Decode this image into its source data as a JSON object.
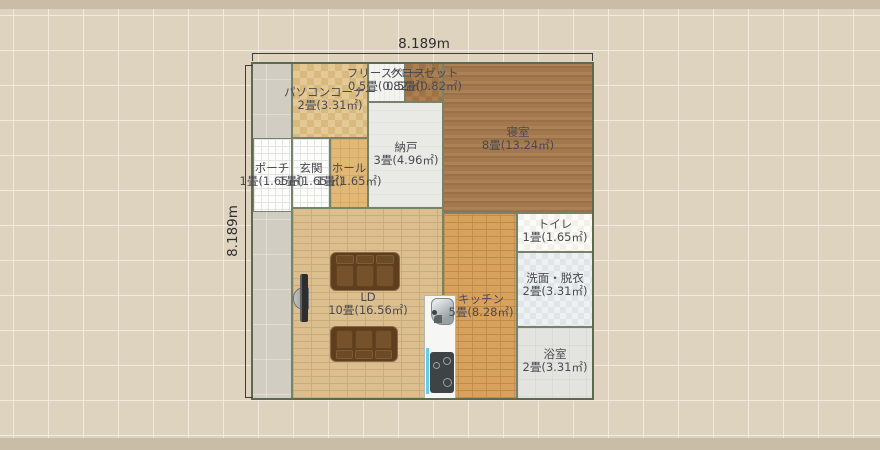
{
  "plan": {
    "dimensions": {
      "width_label": "8.189m",
      "height_label": "8.189m"
    },
    "rooms": {
      "pc_corner": {
        "name": "パソコンコーナー",
        "size": "2畳(3.31㎡)"
      },
      "free_space": {
        "name": "フリースペース",
        "size": "0.5畳(0.82㎡)"
      },
      "closet": {
        "name": "クローゼット",
        "size": "0.5畳(0.82㎡)"
      },
      "storage": {
        "name": "納戸",
        "size": "3畳(4.96㎡)"
      },
      "bedroom": {
        "name": "寝室",
        "size": "8畳(13.24㎡)"
      },
      "porch": {
        "name": "ポーチ",
        "size": "1畳(1.65㎡)"
      },
      "entrance": {
        "name": "玄関",
        "size": "1畳(1.65㎡)"
      },
      "hall": {
        "name": "ホール",
        "size": "1畳(1.65㎡)"
      },
      "living_dining": {
        "name": "LD",
        "size": "10畳(16.56㎡)"
      },
      "kitchen": {
        "name": "キッチン",
        "size": "5畳(8.28㎡)"
      },
      "toilet": {
        "name": "トイレ",
        "size": "1畳(1.65㎡)"
      },
      "washroom": {
        "name": "洗面・脱衣",
        "size": "2畳(3.31㎡)"
      },
      "bathroom": {
        "name": "浴室",
        "size": "2畳(3.31㎡)"
      }
    },
    "furniture": [
      "sofa",
      "sofa",
      "tv",
      "refrigerator",
      "stove",
      "sink"
    ],
    "colors": {
      "canvas_bg": "#ddd3bf",
      "canvas_band": "#c9bda7",
      "wall": "#5d6950",
      "text": "#4a4a52",
      "floor_ld": "#dcbf8f",
      "floor_kitchen": "#d8a25e",
      "floor_bedroom": "#a67c50",
      "floor_closet": "#a57a4b",
      "floor_pc_corner": "#debf8a",
      "floor_hall": "#e2b876",
      "floor_washroom": "#e7ebec",
      "sofa": "#6b4a26",
      "sink_accent": "#66cbe8"
    }
  }
}
